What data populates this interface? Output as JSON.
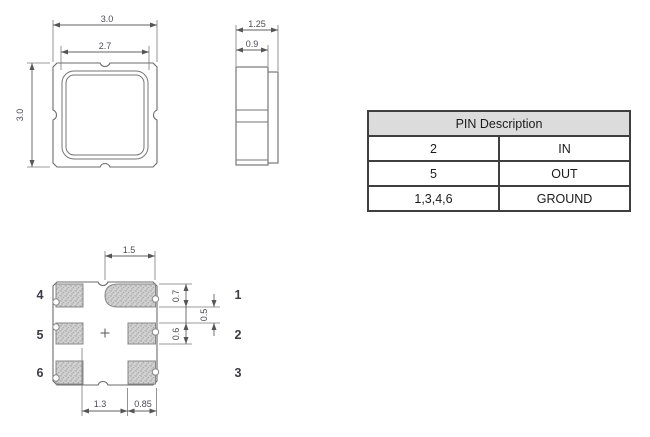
{
  "drawings": {
    "units_implied": "mm",
    "top_view": {
      "label": "package-top-view",
      "dim_outer_width": "3.0",
      "dim_lid_width": "2.7",
      "dim_outer_height": "3.0"
    },
    "side_view": {
      "label": "package-side-view",
      "dim_overall_width": "1.25",
      "dim_body_width": "0.9"
    },
    "bottom_view": {
      "label": "package-bottom-view",
      "dim_pad1_width": "1.5",
      "dim_pad1_height": "0.7",
      "dim_pad_gap_vertical": "0.5",
      "dim_pad2_height": "0.6",
      "dim_pad_gap_horizontal": "1.3",
      "dim_side_pad_width": "0.85",
      "pin_labels": {
        "left": [
          "4",
          "5",
          "6"
        ],
        "right": [
          "1",
          "2",
          "3"
        ]
      }
    }
  },
  "table": {
    "header": "PIN Description",
    "rows": [
      {
        "pin": "2",
        "desc": "IN"
      },
      {
        "pin": "5",
        "desc": "OUT"
      },
      {
        "pin": "1,3,4,6",
        "desc": "GROUND"
      }
    ]
  },
  "colors": {
    "drawing_line": "#6b6b6b",
    "dim_text": "#4b4b57",
    "pad_fill_base": "#d2d2d2",
    "pad_speckle": "#9b9b9b",
    "table_border": "#3f3f3f",
    "table_header_bg": "#dcdcdc",
    "background": "#ffffff"
  }
}
